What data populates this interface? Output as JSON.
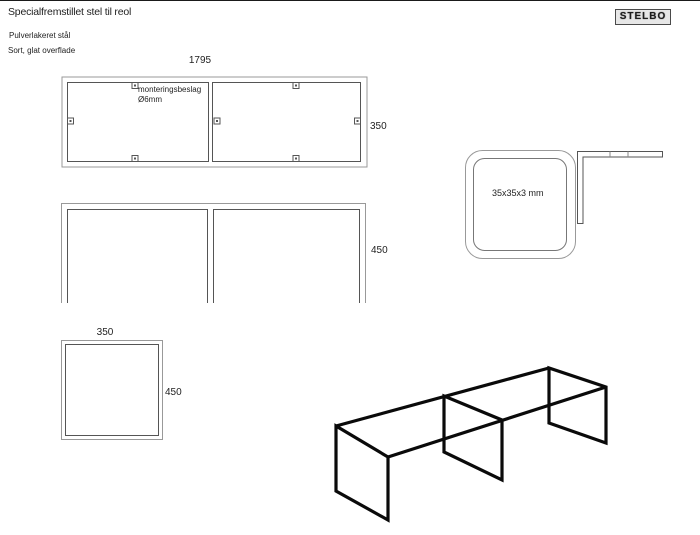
{
  "header": {
    "title": "Specialfremstillet stel til reol",
    "material_line1": "Pulverlakeret stål",
    "material_line2": "Sort, glat overflade",
    "logo_text": "STELBO"
  },
  "top_view": {
    "length_dim": "1795",
    "depth_dim": "350",
    "note_line1": "monteringsbeslag",
    "note_line2": "Ø6mm"
  },
  "front_view": {
    "height_dim": "450"
  },
  "side_view": {
    "width_dim": "350",
    "height_dim": "450"
  },
  "profile_detail": {
    "size_label": "35x35x3 mm"
  },
  "colors": {
    "outer_line": "#999999",
    "inner_line": "#555555",
    "sketch_line": "#0a0a0a",
    "text": "#222222"
  }
}
